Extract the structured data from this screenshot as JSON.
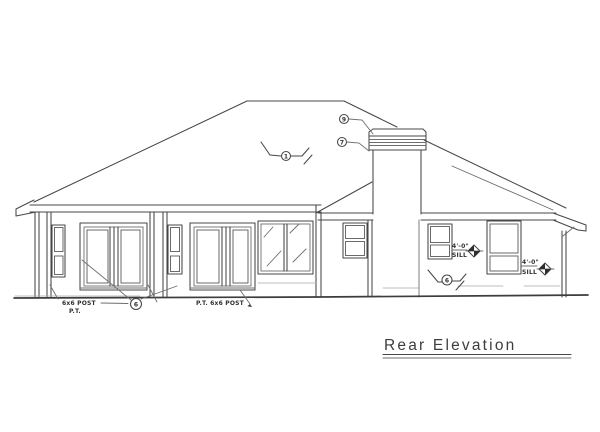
{
  "title": {
    "label": "Rear Elevation"
  },
  "annotations": {
    "left_post_label": "6x6 POST",
    "left_post_sub": "P.T.",
    "right_post_label": "P.T. 6x6 POST",
    "sill_1": {
      "value": "4'-0\"",
      "label": "SILL"
    },
    "sill_2": {
      "value": "4'-0\"",
      "label": "SILL"
    },
    "callout_roof": "1",
    "callout_chimney_upper": "9",
    "callout_chimney_lower": "7",
    "callout_posts": "6",
    "callout_wall": "6"
  },
  "colors": {
    "line": "#474747",
    "paper": "#ffffff"
  }
}
